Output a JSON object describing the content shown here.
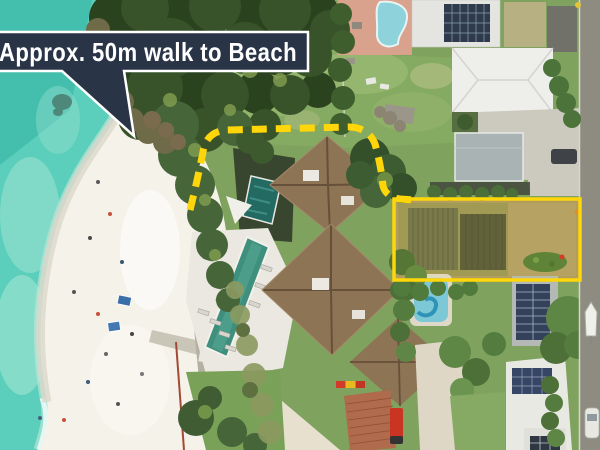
{
  "callout": {
    "text": "Approx. 50m walk to Beach",
    "bg_color": "#2A3447",
    "border_color": "#FFFFFF",
    "text_color": "#FFFFFF"
  },
  "annotations": {
    "highlight_color": "#FFD60A",
    "property_outline_shape": "rectangle",
    "walk_path_style": "dashed"
  },
  "scene": {
    "type": "aerial-photograph",
    "colors": {
      "water": "#5BCFBB",
      "water_deep": "#3DB9A8",
      "sand": "#F5F2EA",
      "grass": "#7FA35E",
      "canopy": "#38522A",
      "roof_brown": "#8D7454",
      "road": "#8E8B81",
      "terracotta": "#B06A4C",
      "pool_teal": "#3F8F7E"
    }
  }
}
